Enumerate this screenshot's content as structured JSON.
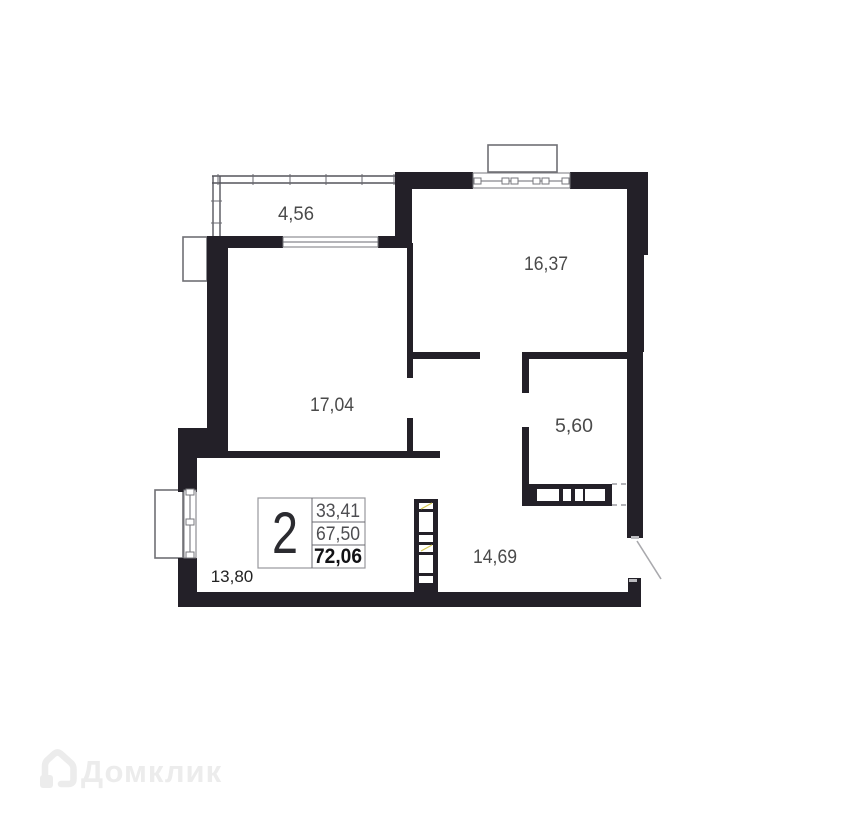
{
  "plan": {
    "rooms": [
      {
        "id": "balcony",
        "label": "4,56"
      },
      {
        "id": "top-right-room",
        "label": "16,37"
      },
      {
        "id": "left-room",
        "label": "17,04"
      },
      {
        "id": "small-room",
        "label": "5,60"
      },
      {
        "id": "hallway",
        "label": "14,69"
      },
      {
        "id": "bottom-left-room",
        "label": "13,80"
      }
    ],
    "summary": {
      "rooms_count": "2",
      "value_top": "33,41",
      "value_middle": "67,50",
      "value_bottom": "72,06"
    }
  },
  "watermark": {
    "brand": "Домклик"
  },
  "colors": {
    "wall": "#232028",
    "room_label": "#4a4a4a",
    "watermark": "#ececec",
    "shaft_accent": "#d4c74f"
  }
}
